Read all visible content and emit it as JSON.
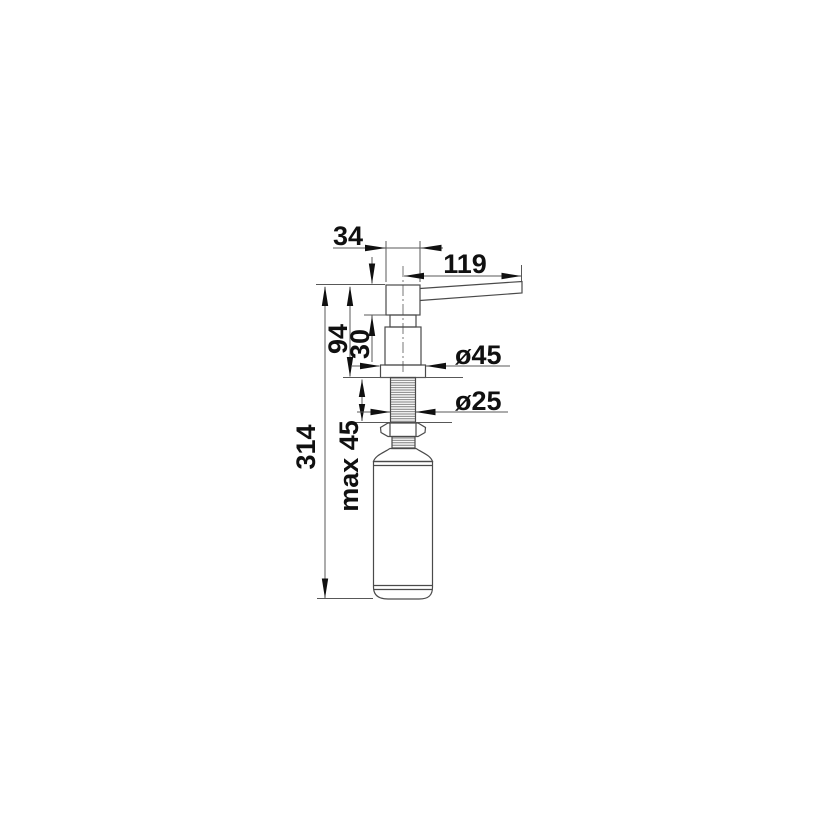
{
  "drawing": {
    "subject": "soap-dispenser-technical-dimension-drawing",
    "units": "mm",
    "dimensions": {
      "head_width": "34",
      "spout_reach": "119",
      "height_above_deck": "94",
      "head_height": "30",
      "total_height": "314",
      "max_deck_thickness": "max 45",
      "flange_diameter": "ø45",
      "thread_diameter": "ø25"
    },
    "colors": {
      "background": "#ffffff",
      "line": "#4a4a4a",
      "dim_line": "#585858",
      "text": "#101010"
    }
  }
}
